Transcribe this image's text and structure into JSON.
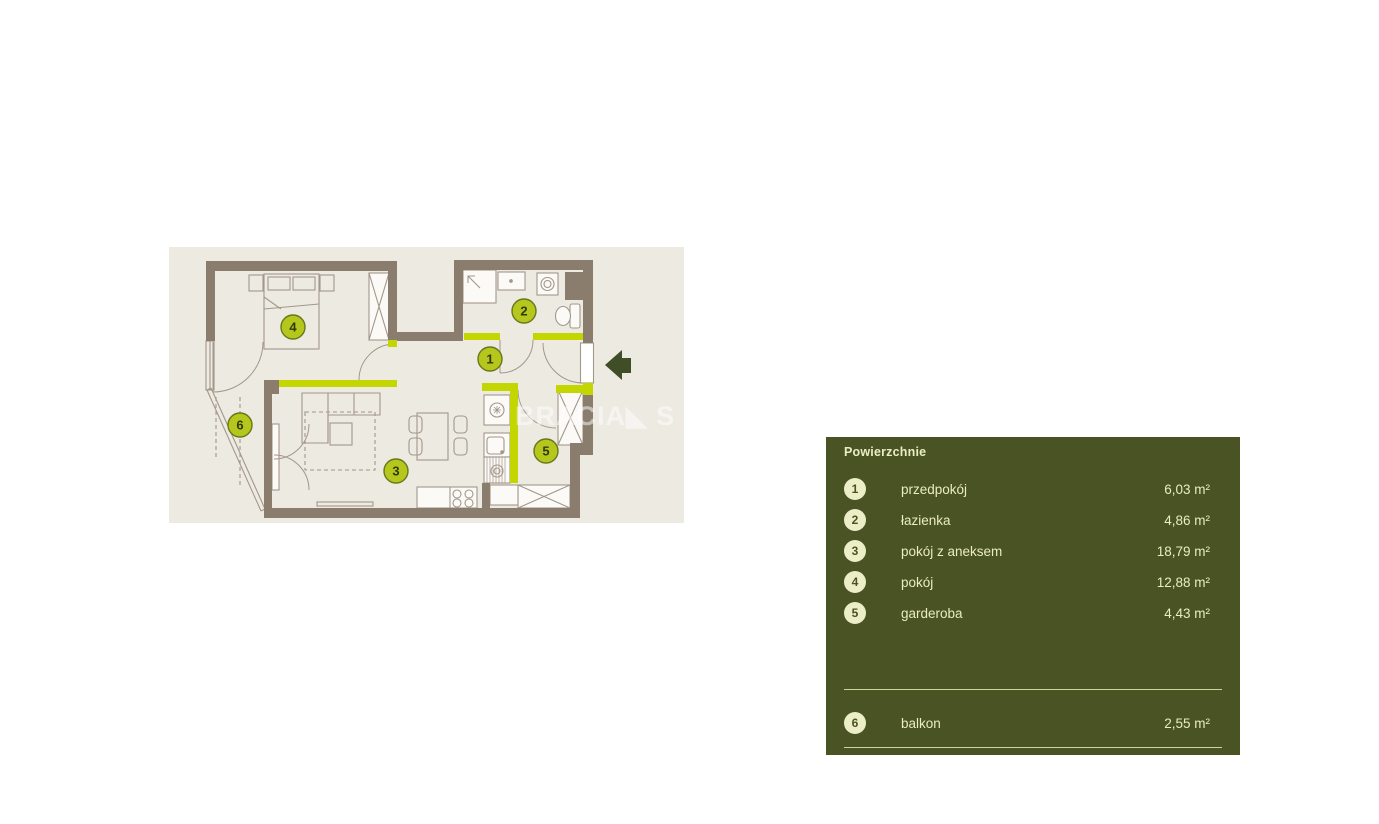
{
  "plan": {
    "watermark": "BRACIA◣ S",
    "colors": {
      "floor": "#edeae2",
      "wall": "#8b7d6e",
      "accent": "#c4d600",
      "furniture_line": "#a3978a",
      "marker_fill": "#b5c71d",
      "marker_border": "#68781a",
      "marker_text": "#2f3a0b",
      "entrance_arrow": "#3f4e26"
    },
    "entrance_arrow_icon": "left-arrow"
  },
  "legend": {
    "title": "Powierzchnie",
    "colors": {
      "panel": "#4a5323",
      "text": "#e9ecc4",
      "circle_fill": "#ebeec6",
      "circle_text": "#49531f",
      "divider": "#ccd69c"
    },
    "rooms": [
      {
        "number": "1",
        "label": "przedpokój",
        "area": "6,03 m²"
      },
      {
        "number": "2",
        "label": "łazienka",
        "area": "4,86 m²"
      },
      {
        "number": "3",
        "label": "pokój z aneksem",
        "area": "18,79 m²"
      },
      {
        "number": "4",
        "label": "pokój",
        "area": "12,88 m²"
      },
      {
        "number": "5",
        "label": "garderoba",
        "area": "4,43 m²"
      },
      {
        "number": "6",
        "label": "balkon",
        "area": "2,55 m²"
      }
    ]
  }
}
